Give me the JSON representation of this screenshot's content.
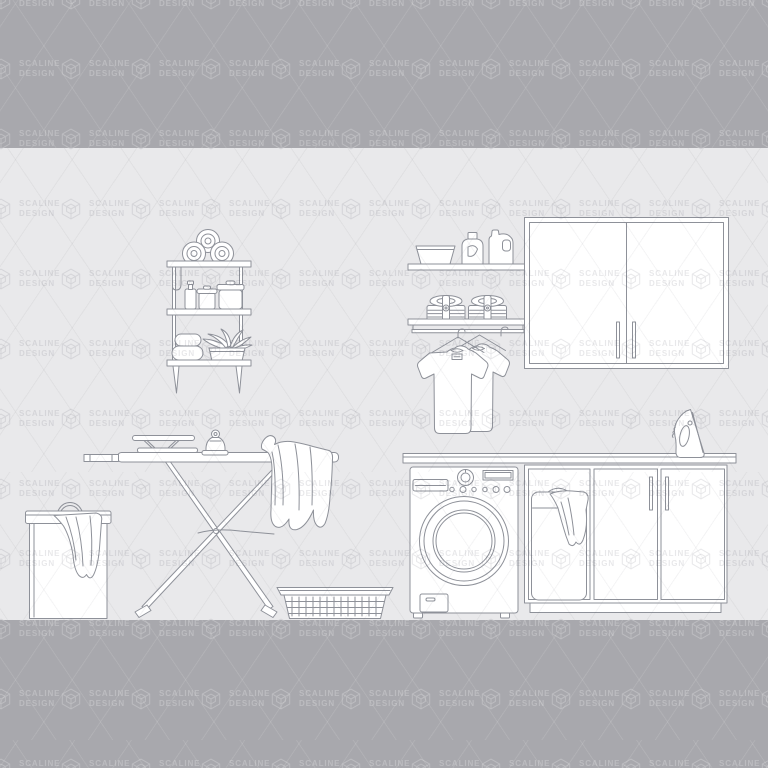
{
  "image": {
    "kind": "watermarked stock illustration preview",
    "subject": "Laundry room interior outline vector set",
    "width_px": 768,
    "height_px": 768
  },
  "watermark": {
    "brand_line1": "SCALINE",
    "brand_line2": "DESIGN",
    "logo": "isometric-cube-logo",
    "pattern": "repeating logo+text grid with diagonal lattice lines"
  },
  "colors": {
    "letterbox_band": "#a8a8ad",
    "wall_background": "#e9e9eb",
    "line_art_stroke": "#8e9199",
    "object_fill": "#ffffff",
    "watermark_on_dark": "rgba(255,255,255,0.24)",
    "watermark_on_light": "rgba(100,100,114,0.15)",
    "lattice_on_dark": "rgba(255,255,255,0.10)",
    "lattice_on_light": "rgba(100,100,114,0.07)"
  },
  "layout": {
    "top_band": {
      "y": 0,
      "height": 148
    },
    "illustration_band": {
      "y": 148,
      "height": 472
    },
    "bottom_band": {
      "y": 620,
      "height": 148
    },
    "watermark_grid": {
      "origin_x": -10,
      "origin_y": -12,
      "pitch_x": 70,
      "pitch_y": 70
    }
  },
  "scene": {
    "items": [
      {
        "name": "wall-shelf-unit",
        "details": "three boards with rolled towels, spray bottle, two lidded jars, stacked towels, plant basket, hanging hook"
      },
      {
        "name": "upper-wall-shelf",
        "details": "wash basin, detergent bottle, bleach jug"
      },
      {
        "name": "lower-wall-shelf",
        "details": "two strapped folded-laundry bundles above a hanging rail"
      },
      {
        "name": "t-shirts-on-hangers",
        "count": 2
      },
      {
        "name": "wall-cabinet",
        "details": "double doors with vertical handles"
      },
      {
        "name": "ironing-board",
        "details": "X legs, sleeve board, vintage iron, garment draped over end"
      },
      {
        "name": "laundry-hamper",
        "details": "lidded hamper with cloth hanging out"
      },
      {
        "name": "laundry-basket",
        "details": "woven basket on floor"
      },
      {
        "name": "washing-machine",
        "details": "front load, detergent drawer, dial, display, six buttons, round door, service hatch"
      },
      {
        "name": "base-cabinet",
        "details": "open bay with laundry bag, two doors, shared countertop"
      },
      {
        "name": "upright-steam-iron",
        "details": "standing on countertop"
      }
    ]
  }
}
